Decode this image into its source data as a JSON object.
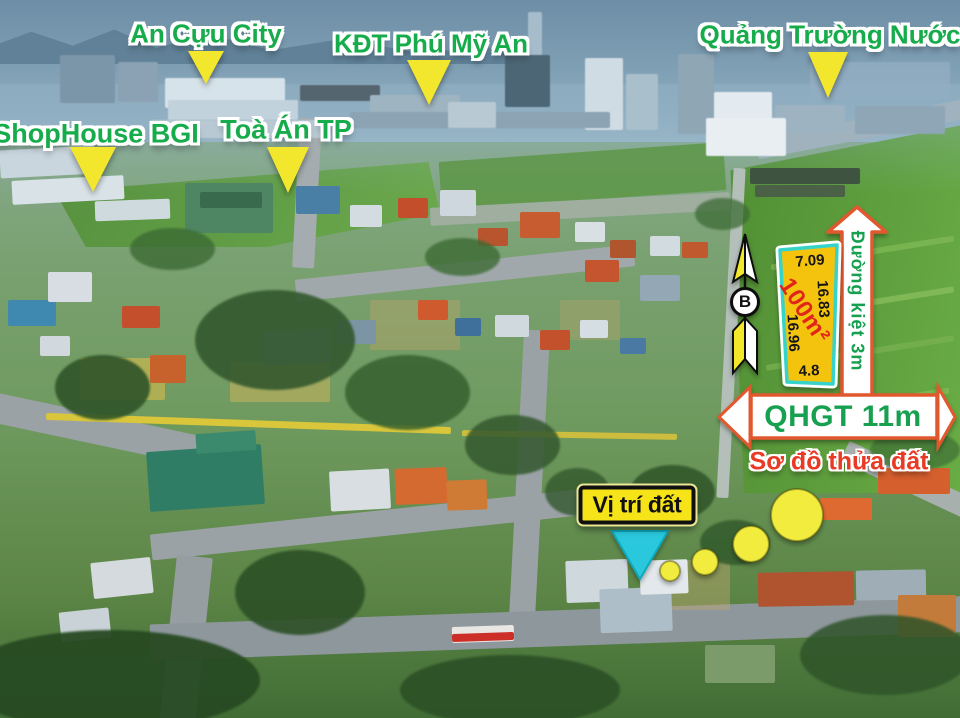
{
  "badges": {
    "an_cuu_city": "An Cựu City",
    "kdt_phu_my_an": "KĐT Phú Mỹ An",
    "quang_truong_nuoc": "Quảng Trường Nước",
    "shophouse_bgi": "ShopHouse BGI",
    "toa_an_tp": "Toà Án TP"
  },
  "compass": {
    "north_letter": "B"
  },
  "parcel": {
    "area_label": "100m²",
    "edge_top": "7.09",
    "edge_right": "16.83",
    "edge_left": "16.96",
    "edge_bottom": "4.8"
  },
  "roads": {
    "alley_label": "Đường kiệt 3m",
    "planned_road_label": "QHGT 11m"
  },
  "captions": {
    "site_plan": "Sơ đồ thửa đất",
    "location": "Vị trí đất"
  },
  "colors": {
    "label_green": "#17ac4b",
    "marker_yellow": "#f2e72c",
    "parcel_fill": "#f4c30e",
    "parcel_border": "#35d3c9",
    "area_red": "#e1251b",
    "road_sign_border": "#e2582e",
    "road_sign_text": "#17a04f",
    "site_plan_red": "#e93a25",
    "location_box_yellow": "#f6e318",
    "location_pointer_cyan": "#29c8dc",
    "trail_dot_yellow": "#f1ec3d"
  }
}
